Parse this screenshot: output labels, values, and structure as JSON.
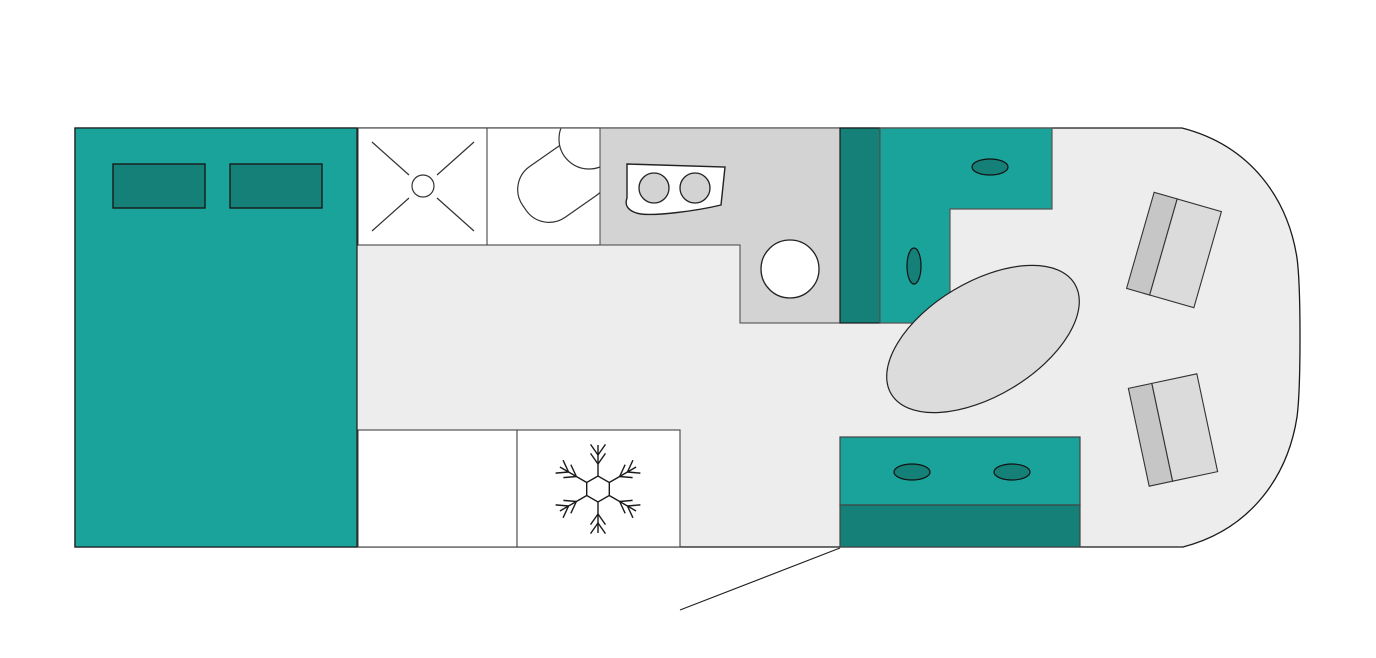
{
  "canvas": {
    "width": 1376,
    "height": 658,
    "background": "#FFFFFF"
  },
  "palette": {
    "teal": "#1AA39B",
    "teal_dark": "#148078",
    "floor": "#EDEDED",
    "counter_gray": "#D3D3D3",
    "seat_cushion_gray": "#DBDBDB",
    "seat_back_gray": "#C6C6C6",
    "table_gray": "#DCDCDC",
    "outline_dark": "#1A1A1A",
    "outline_mid": "#333333"
  },
  "floorplan": {
    "elements": [
      {
        "name": "vehicle-hull",
        "interactable": false,
        "shapes": [
          {
            "type": "path",
            "d": "M 75 128 L 1182 128 C 1252 146 1288 200 1297 258 C 1301 288 1301 387 1297 417 C 1288 475 1252 529 1183 547 L 75 547 Z",
            "fill": "#EDEDED",
            "stroke": "#1A1A1A",
            "sw": 1.3
          }
        ]
      },
      {
        "name": "bed",
        "interactable": false,
        "shapes": [
          {
            "type": "rect",
            "x": 75,
            "y": 128,
            "w": 282,
            "h": 419,
            "fill": "#1AA39B",
            "stroke": "#1A1A1A",
            "sw": 1.2
          }
        ]
      },
      {
        "name": "bed-pillow-left",
        "interactable": false,
        "shapes": [
          {
            "type": "rect",
            "x": 113,
            "y": 164,
            "w": 92,
            "h": 44,
            "fill": "#148078",
            "stroke": "#1A1A1A",
            "sw": 1.4
          }
        ]
      },
      {
        "name": "bed-pillow-right",
        "interactable": false,
        "shapes": [
          {
            "type": "rect",
            "x": 230,
            "y": 164,
            "w": 92,
            "h": 44,
            "fill": "#148078",
            "stroke": "#1A1A1A",
            "sw": 1.4
          }
        ]
      },
      {
        "name": "shower-tray",
        "interactable": false,
        "shapes": [
          {
            "type": "rect",
            "x": 358,
            "y": 128,
            "w": 129,
            "h": 117,
            "fill": "#FFFFFF",
            "stroke": "#333333",
            "sw": 1
          },
          {
            "type": "line",
            "x1": 372,
            "y1": 142,
            "x2": 409,
            "y2": 175,
            "stroke": "#333333",
            "sw": 1.2
          },
          {
            "type": "line",
            "x1": 474,
            "y1": 142,
            "x2": 437,
            "y2": 175,
            "stroke": "#333333",
            "sw": 1.2
          },
          {
            "type": "line",
            "x1": 372,
            "y1": 231,
            "x2": 409,
            "y2": 198,
            "stroke": "#333333",
            "sw": 1.2
          },
          {
            "type": "line",
            "x1": 474,
            "y1": 231,
            "x2": 437,
            "y2": 198,
            "stroke": "#333333",
            "sw": 1.2
          },
          {
            "type": "circle",
            "cx": 423,
            "cy": 186,
            "r": 11,
            "fill": "#FFFFFF",
            "stroke": "#333333",
            "sw": 1.2
          }
        ]
      },
      {
        "name": "toilet-room",
        "interactable": false,
        "shapes": [
          {
            "type": "rect",
            "x": 487,
            "y": 128,
            "w": 113,
            "h": 117,
            "fill": "#FFFFFF",
            "stroke": "#333333",
            "sw": 1
          },
          {
            "type": "rect",
            "x": -47,
            "y": -31,
            "w": 94,
            "h": 62,
            "rx": 28,
            "tf": "translate(563,181) rotate(-35)",
            "fill": "#FFFFFF",
            "stroke": "#333333",
            "sw": 1.2,
            "clip": [
              488,
              128.6,
              111.5,
              116
            ]
          },
          {
            "type": "circle",
            "cx": 589,
            "cy": 139,
            "r": 30,
            "fill": "#FFFFFF",
            "stroke": "#333333",
            "sw": 1.2,
            "clip": [
              488,
              128.6,
              111.5,
              116
            ]
          },
          {
            "type": "rect",
            "x": 487,
            "y": 128,
            "w": 113,
            "h": 117,
            "stroke": "#333333",
            "sw": 1
          }
        ]
      },
      {
        "name": "kitchen-counter",
        "interactable": false,
        "shapes": [
          {
            "type": "polygon",
            "points": "600,128 840,128 840,323 740,323 740,245 600,245",
            "fill": "#D3D3D3",
            "stroke": "#444444",
            "sw": 1
          }
        ]
      },
      {
        "name": "stove",
        "interactable": false,
        "shapes": [
          {
            "type": "path",
            "d": "M 627 164 L 725 167 L 721 205 C 696 211 656 216 641 214 C 629 212 624 206 627 198 Z",
            "fill": "#FFFFFF",
            "stroke": "#222222",
            "sw": 1.4
          },
          {
            "type": "circle",
            "cx": 654,
            "cy": 188,
            "r": 15,
            "fill": "#D3D3D3",
            "stroke": "#222222",
            "sw": 1.3
          },
          {
            "type": "circle",
            "cx": 695,
            "cy": 188,
            "r": 15,
            "fill": "#D3D3D3",
            "stroke": "#222222",
            "sw": 1.3
          }
        ]
      },
      {
        "name": "sink",
        "interactable": false,
        "shapes": [
          {
            "type": "circle",
            "cx": 790,
            "cy": 269,
            "r": 29,
            "fill": "#FFFFFF",
            "stroke": "#222222",
            "sw": 1.3
          }
        ]
      },
      {
        "name": "wardrobe",
        "interactable": false,
        "shapes": [
          {
            "type": "rect",
            "x": 840,
            "y": 128,
            "w": 40,
            "h": 195,
            "fill": "#148078",
            "stroke": "#1A1A1A",
            "sw": 1.2
          }
        ]
      },
      {
        "name": "lounge-bench",
        "interactable": false,
        "shapes": [
          {
            "type": "polygon",
            "points": "880,128 1052,128 1052,209 950,209 950,323 880,323",
            "fill": "#1AA39B",
            "stroke": "#555555",
            "sw": 1.2
          },
          {
            "type": "ellipse",
            "cx": 990,
            "cy": 167,
            "rx": 18,
            "ry": 8,
            "fill": "#148078",
            "stroke": "#111111",
            "sw": 1.2
          },
          {
            "type": "ellipse",
            "cx": 914,
            "cy": 266,
            "rx": 7,
            "ry": 18,
            "fill": "#148078",
            "stroke": "#111111",
            "sw": 1.2
          }
        ]
      },
      {
        "name": "dinette-table",
        "interactable": false,
        "shapes": [
          {
            "type": "ellipse",
            "cx": 983,
            "cy": 339,
            "rx": 107,
            "ry": 57,
            "tf": "rotate(-31 983 339)",
            "fill": "#DCDCDC",
            "stroke": "#222222",
            "sw": 1.2
          }
        ]
      },
      {
        "name": "cab-seat-upper",
        "interactable": false,
        "shapes": [
          {
            "type": "rect",
            "x": -35,
            "y": -50,
            "w": 24,
            "h": 100,
            "tf": "translate(1174,250) rotate(16)",
            "fill": "#C6C6C6",
            "stroke": "#333333",
            "sw": 1.1
          },
          {
            "type": "rect",
            "x": -11,
            "y": -50,
            "w": 46,
            "h": 100,
            "tf": "translate(1174,250) rotate(16)",
            "fill": "#DBDBDB",
            "stroke": "#333333",
            "sw": 1.1
          }
        ]
      },
      {
        "name": "cab-seat-lower",
        "interactable": false,
        "shapes": [
          {
            "type": "rect",
            "x": -35,
            "y": -50,
            "w": 24,
            "h": 100,
            "tf": "translate(1173,430) rotate(-12)",
            "fill": "#C6C6C6",
            "stroke": "#333333",
            "sw": 1.1
          },
          {
            "type": "rect",
            "x": -11,
            "y": -50,
            "w": 46,
            "h": 100,
            "tf": "translate(1173,430) rotate(-12)",
            "fill": "#DBDBDB",
            "stroke": "#333333",
            "sw": 1.1
          }
        ]
      },
      {
        "name": "entry-bench",
        "interactable": false,
        "shapes": [
          {
            "type": "rect",
            "x": 840,
            "y": 437,
            "w": 240,
            "h": 68,
            "fill": "#1AA39B",
            "stroke": "#444444",
            "sw": 1.2
          },
          {
            "type": "rect",
            "x": 840,
            "y": 505,
            "w": 240,
            "h": 42,
            "fill": "#148078",
            "stroke": "#444444",
            "sw": 1.2
          },
          {
            "type": "ellipse",
            "cx": 912,
            "cy": 472,
            "rx": 18,
            "ry": 8,
            "fill": "#148078",
            "stroke": "#111111",
            "sw": 1.2
          },
          {
            "type": "ellipse",
            "cx": 1012,
            "cy": 472,
            "rx": 18,
            "ry": 8,
            "fill": "#148078",
            "stroke": "#111111",
            "sw": 1.2
          }
        ]
      },
      {
        "name": "storage-cabinet",
        "interactable": false,
        "shapes": [
          {
            "type": "rect",
            "x": 358,
            "y": 430,
            "w": 159,
            "h": 117,
            "fill": "#FFFFFF",
            "stroke": "#444444",
            "sw": 1.1
          }
        ]
      },
      {
        "name": "refrigerator-cabinet",
        "interactable": false,
        "shapes": [
          {
            "type": "rect",
            "x": 517,
            "y": 430,
            "w": 163,
            "h": 117,
            "fill": "#FFFFFF",
            "stroke": "#444444",
            "sw": 1.1
          }
        ]
      },
      {
        "name": "snowflake-icon",
        "interactable": false,
        "shapes": [
          {
            "type": "snowflake",
            "cx": 598,
            "cy": 489,
            "rhex": 13,
            "rtip": 44,
            "t1": 25,
            "t2": 34,
            "tick": 13,
            "stroke": "#1A1A1A",
            "sw": 1.4
          }
        ]
      },
      {
        "name": "entry-door-swing-line",
        "interactable": false,
        "shapes": [
          {
            "type": "line",
            "x1": 840,
            "y1": 548,
            "x2": 680,
            "y2": 610,
            "stroke": "#222222",
            "sw": 1.2
          }
        ]
      }
    ]
  }
}
